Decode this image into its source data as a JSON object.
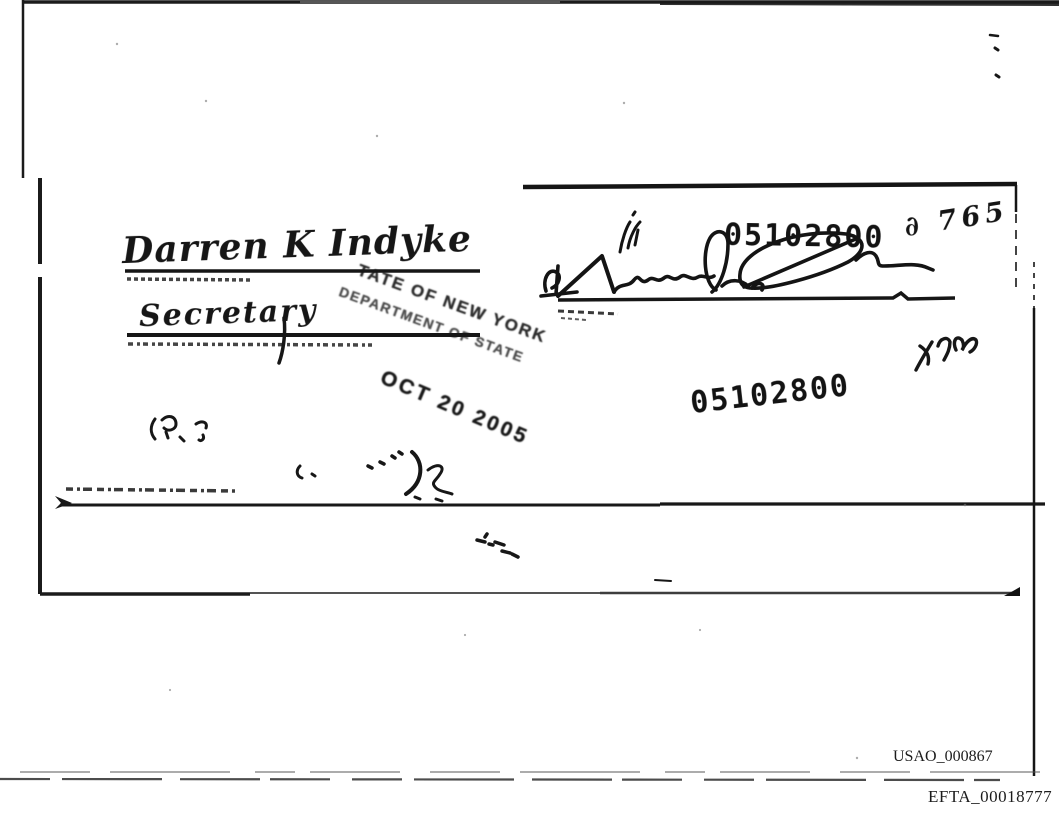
{
  "signatures": {
    "principal_name": "Darren K Indyke",
    "title": "Secretary"
  },
  "stamp": {
    "line1": "TATE OF NEW YORK",
    "line2": "DEPARTMENT OF STATE",
    "date_line": "OCT 20 2005"
  },
  "stamped_numbers": {
    "upper": "05102800",
    "lower": "05102800"
  },
  "handwritten_note": "∂ 765",
  "bates": {
    "usao": "USAO_000867",
    "efta": "EFTA_00018777"
  }
}
